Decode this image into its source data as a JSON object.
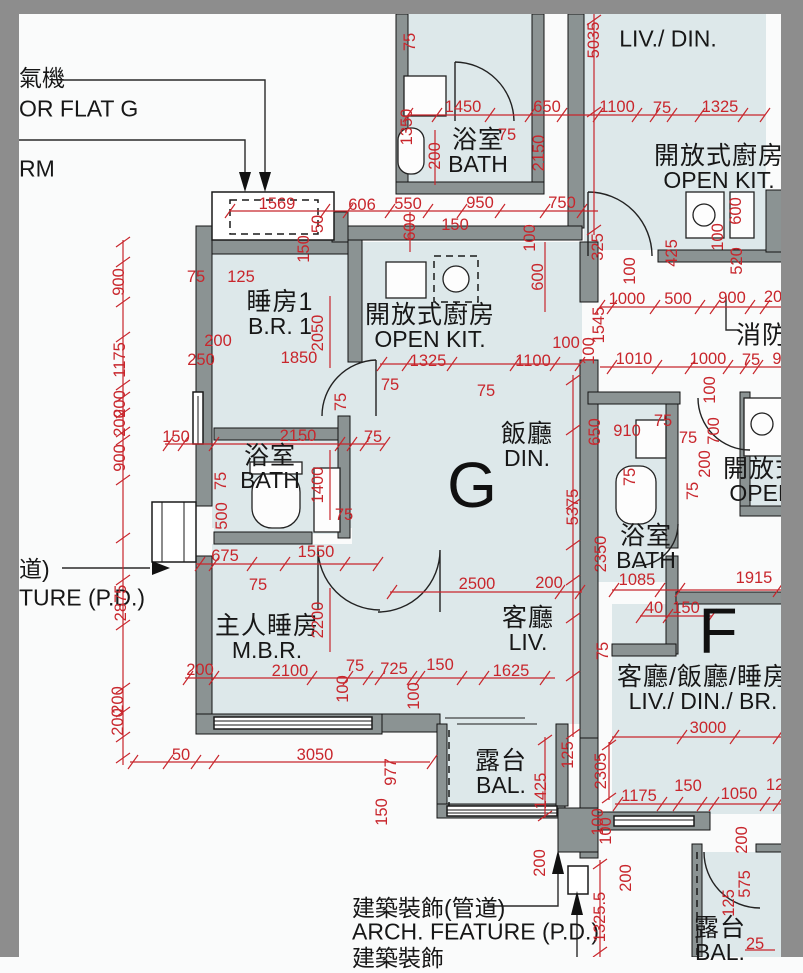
{
  "rooms": {
    "flat_g": {
      "letter": "G"
    },
    "flat_f": {
      "letter": "F"
    },
    "br1": {
      "zh": "睡房1",
      "en": "B.R. 1"
    },
    "open_kit_g": {
      "zh": "開放式廚房",
      "en": "OPEN KIT."
    },
    "bath_g": {
      "zh": "浴室",
      "en": "BATH"
    },
    "din_g": {
      "zh": "飯廳",
      "en": "DIN."
    },
    "liv_g": {
      "zh": "客廳",
      "en": "LIV."
    },
    "mbr": {
      "zh": "主人睡房",
      "en": "M.B.R."
    },
    "bal_g": {
      "zh": "露台",
      "en": "BAL."
    },
    "bath_top": {
      "zh": "浴室",
      "en": "BATH"
    },
    "livdin_top": {
      "en": "LIV./ DIN."
    },
    "open_kit_top": {
      "zh": "開放式廚房",
      "en": "OPEN KIT."
    },
    "fire": {
      "zh": "消防"
    },
    "open_kit_f": {
      "zh": "開放式",
      "en": "OPEN"
    },
    "bath_f": {
      "zh": "浴室",
      "en": "BATH"
    },
    "livdinbr_f": {
      "zh": "客廳/飯廳/睡房",
      "en": "LIV./ DIN./ BR."
    },
    "bal_f": {
      "zh": "露台",
      "en": "BAL."
    }
  },
  "annotations": {
    "ac_unit": "氣機",
    "for_flat_g": "OR FLAT G",
    "rm": "RM",
    "pd_left_zh": "道)",
    "pd_left_en": "TURE (P.D.)",
    "arch_feature_zh": "建築裝飾(管道)",
    "arch_feature_en": "ARCH. FEATURE (P.D.)",
    "arch_feature_partial": "建築裝飾"
  },
  "colors": {
    "dim_red": "#c8262c",
    "wall_gray": "#8b9393",
    "room_fill": "#dde8ea",
    "border_gray": "#8d8d8d"
  },
  "dims": [
    {
      "t": "75",
      "x": 410,
      "y": 42,
      "o": "v"
    },
    {
      "t": "5035",
      "x": 594,
      "y": 40,
      "o": "v"
    },
    {
      "t": "1450",
      "x": 463,
      "y": 107,
      "o": "h"
    },
    {
      "t": "650",
      "x": 547,
      "y": 107,
      "o": "h"
    },
    {
      "t": "1100",
      "x": 617,
      "y": 107,
      "o": "h"
    },
    {
      "t": "75",
      "x": 662,
      "y": 108,
      "o": "h"
    },
    {
      "t": "1325",
      "x": 720,
      "y": 107,
      "o": "h"
    },
    {
      "t": "1350",
      "x": 407,
      "y": 127,
      "o": "v"
    },
    {
      "t": "200",
      "x": 435,
      "y": 156,
      "o": "v"
    },
    {
      "t": "75",
      "x": 507,
      "y": 135,
      "o": "h"
    },
    {
      "t": "2150",
      "x": 539,
      "y": 153,
      "o": "v"
    },
    {
      "t": "1569",
      "x": 277,
      "y": 204,
      "o": "h"
    },
    {
      "t": "606",
      "x": 362,
      "y": 205,
      "o": "h"
    },
    {
      "t": "550",
      "x": 408,
      "y": 204,
      "o": "h"
    },
    {
      "t": "950",
      "x": 480,
      "y": 203,
      "o": "h"
    },
    {
      "t": "750",
      "x": 562,
      "y": 203,
      "o": "h"
    },
    {
      "t": "50",
      "x": 318,
      "y": 224,
      "o": "v"
    },
    {
      "t": "150",
      "x": 304,
      "y": 249,
      "o": "v"
    },
    {
      "t": "600",
      "x": 410,
      "y": 227,
      "o": "v"
    },
    {
      "t": "150",
      "x": 455,
      "y": 225,
      "o": "h"
    },
    {
      "t": "100",
      "x": 530,
      "y": 238,
      "o": "v"
    },
    {
      "t": "75",
      "x": 196,
      "y": 277,
      "o": "h"
    },
    {
      "t": "125",
      "x": 241,
      "y": 277,
      "o": "h"
    },
    {
      "t": "600",
      "x": 736,
      "y": 211,
      "o": "v"
    },
    {
      "t": "100",
      "x": 718,
      "y": 237,
      "o": "v"
    },
    {
      "t": "520",
      "x": 737,
      "y": 261,
      "o": "v"
    },
    {
      "t": "425",
      "x": 672,
      "y": 253,
      "o": "v"
    },
    {
      "t": "325",
      "x": 598,
      "y": 247,
      "o": "v"
    },
    {
      "t": "100",
      "x": 630,
      "y": 271,
      "o": "v"
    },
    {
      "t": "1000",
      "x": 627,
      "y": 299,
      "o": "h"
    },
    {
      "t": "500",
      "x": 678,
      "y": 299,
      "o": "h"
    },
    {
      "t": "900",
      "x": 732,
      "y": 298,
      "o": "h"
    },
    {
      "t": "20",
      "x": 773,
      "y": 297,
      "o": "h"
    },
    {
      "t": "1545",
      "x": 599,
      "y": 325,
      "o": "v"
    },
    {
      "t": "100",
      "x": 589,
      "y": 351,
      "o": "v"
    },
    {
      "t": "1010",
      "x": 634,
      "y": 359,
      "o": "h"
    },
    {
      "t": "1000",
      "x": 708,
      "y": 359,
      "o": "h"
    },
    {
      "t": "75",
      "x": 751,
      "y": 360,
      "o": "h"
    },
    {
      "t": "9",
      "x": 777,
      "y": 359,
      "o": "h"
    },
    {
      "t": "100",
      "x": 566,
      "y": 343,
      "o": "h"
    },
    {
      "t": "200",
      "x": 218,
      "y": 341,
      "o": "h"
    },
    {
      "t": "250",
      "x": 201,
      "y": 360,
      "o": "h"
    },
    {
      "t": "1850",
      "x": 299,
      "y": 358,
      "o": "h"
    },
    {
      "t": "2050",
      "x": 318,
      "y": 333,
      "o": "v"
    },
    {
      "t": "900",
      "x": 119,
      "y": 282,
      "o": "v"
    },
    {
      "t": "1175",
      "x": 120,
      "y": 360,
      "o": "v"
    },
    {
      "t": "200",
      "x": 120,
      "y": 404,
      "o": "v"
    },
    {
      "t": "200",
      "x": 120,
      "y": 423,
      "o": "v"
    },
    {
      "t": "900",
      "x": 120,
      "y": 458,
      "o": "v"
    },
    {
      "t": "2875",
      "x": 121,
      "y": 603,
      "o": "v"
    },
    {
      "t": "200",
      "x": 118,
      "y": 700,
      "o": "v"
    },
    {
      "t": "200",
      "x": 118,
      "y": 722,
      "o": "v"
    },
    {
      "t": "1325",
      "x": 428,
      "y": 361,
      "o": "h"
    },
    {
      "t": "1100",
      "x": 533,
      "y": 361,
      "o": "h"
    },
    {
      "t": "75",
      "x": 390,
      "y": 385,
      "o": "h"
    },
    {
      "t": "75",
      "x": 486,
      "y": 391,
      "o": "h"
    },
    {
      "t": "600",
      "x": 538,
      "y": 277,
      "o": "v"
    },
    {
      "t": "75",
      "x": 341,
      "y": 402,
      "o": "v"
    },
    {
      "t": "150",
      "x": 176,
      "y": 437,
      "o": "h"
    },
    {
      "t": "2150",
      "x": 298,
      "y": 436,
      "o": "h"
    },
    {
      "t": "75",
      "x": 373,
      "y": 437,
      "o": "h"
    },
    {
      "t": "1400",
      "x": 318,
      "y": 485,
      "o": "v"
    },
    {
      "t": "75",
      "x": 221,
      "y": 481,
      "o": "v"
    },
    {
      "t": "500",
      "x": 222,
      "y": 516,
      "o": "v"
    },
    {
      "t": "75",
      "x": 344,
      "y": 515,
      "o": "h"
    },
    {
      "t": "675",
      "x": 225,
      "y": 556,
      "o": "h"
    },
    {
      "t": "1550",
      "x": 316,
      "y": 552,
      "o": "h"
    },
    {
      "t": "75",
      "x": 258,
      "y": 585,
      "o": "h"
    },
    {
      "t": "2200",
      "x": 318,
      "y": 620,
      "o": "v"
    },
    {
      "t": "5375",
      "x": 573,
      "y": 507,
      "o": "v"
    },
    {
      "t": "2500",
      "x": 477,
      "y": 584,
      "o": "h"
    },
    {
      "t": "200",
      "x": 549,
      "y": 583,
      "o": "h"
    },
    {
      "t": "200",
      "x": 200,
      "y": 670,
      "o": "h"
    },
    {
      "t": "2100",
      "x": 290,
      "y": 671,
      "o": "h"
    },
    {
      "t": "75",
      "x": 355,
      "y": 666,
      "o": "h"
    },
    {
      "t": "100",
      "x": 343,
      "y": 689,
      "o": "v"
    },
    {
      "t": "725",
      "x": 394,
      "y": 669,
      "o": "h"
    },
    {
      "t": "150",
      "x": 440,
      "y": 665,
      "o": "h"
    },
    {
      "t": "100",
      "x": 414,
      "y": 696,
      "o": "v"
    },
    {
      "t": "1625",
      "x": 511,
      "y": 671,
      "o": "h"
    },
    {
      "t": "50",
      "x": 181,
      "y": 755,
      "o": "h"
    },
    {
      "t": "3050",
      "x": 315,
      "y": 755,
      "o": "h"
    },
    {
      "t": "977",
      "x": 391,
      "y": 772,
      "o": "v"
    },
    {
      "t": "150",
      "x": 382,
      "y": 812,
      "o": "v"
    },
    {
      "t": "1425",
      "x": 541,
      "y": 791,
      "o": "v"
    },
    {
      "t": "125",
      "x": 568,
      "y": 755,
      "o": "v"
    },
    {
      "t": "2305",
      "x": 601,
      "y": 771,
      "o": "v"
    },
    {
      "t": "100",
      "x": 598,
      "y": 822,
      "o": "v"
    },
    {
      "t": "200",
      "x": 540,
      "y": 863,
      "o": "v"
    },
    {
      "t": "1325.5",
      "x": 600,
      "y": 917,
      "o": "v"
    },
    {
      "t": "650",
      "x": 595,
      "y": 432,
      "o": "v"
    },
    {
      "t": "910",
      "x": 627,
      "y": 431,
      "o": "h"
    },
    {
      "t": "75",
      "x": 663,
      "y": 421,
      "o": "h"
    },
    {
      "t": "75",
      "x": 688,
      "y": 438,
      "o": "h"
    },
    {
      "t": "100",
      "x": 710,
      "y": 390,
      "o": "v"
    },
    {
      "t": "700",
      "x": 714,
      "y": 431,
      "o": "v"
    },
    {
      "t": "200",
      "x": 705,
      "y": 464,
      "o": "v"
    },
    {
      "t": "75",
      "x": 693,
      "y": 491,
      "o": "v"
    },
    {
      "t": "75",
      "x": 630,
      "y": 477,
      "o": "v"
    },
    {
      "t": "2350",
      "x": 601,
      "y": 554,
      "o": "v"
    },
    {
      "t": "1085",
      "x": 637,
      "y": 580,
      "o": "h"
    },
    {
      "t": "1915",
      "x": 754,
      "y": 578,
      "o": "h"
    },
    {
      "t": "40",
      "x": 654,
      "y": 608,
      "o": "h"
    },
    {
      "t": "150",
      "x": 686,
      "y": 608,
      "o": "h"
    },
    {
      "t": "75",
      "x": 603,
      "y": 651,
      "o": "v"
    },
    {
      "t": "3000",
      "x": 708,
      "y": 728,
      "o": "h"
    },
    {
      "t": "1175",
      "x": 639,
      "y": 796,
      "o": "h"
    },
    {
      "t": "150",
      "x": 688,
      "y": 786,
      "o": "h"
    },
    {
      "t": "1050",
      "x": 739,
      "y": 794,
      "o": "h"
    },
    {
      "t": "12",
      "x": 775,
      "y": 785,
      "o": "h"
    },
    {
      "t": "100",
      "x": 606,
      "y": 831,
      "o": "v"
    },
    {
      "t": "200",
      "x": 626,
      "y": 878,
      "o": "v"
    },
    {
      "t": "200",
      "x": 742,
      "y": 840,
      "o": "v"
    },
    {
      "t": "575",
      "x": 745,
      "y": 884,
      "o": "v"
    },
    {
      "t": "125",
      "x": 729,
      "y": 903,
      "o": "v"
    },
    {
      "t": "25",
      "x": 755,
      "y": 944,
      "o": "h"
    }
  ]
}
